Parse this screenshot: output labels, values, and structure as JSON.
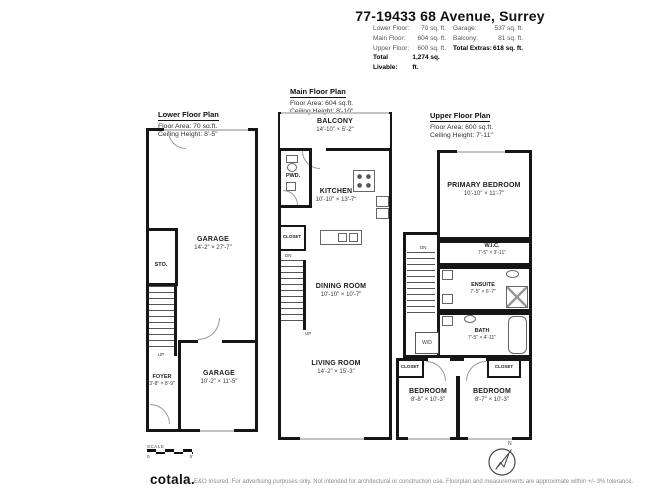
{
  "header": {
    "title": "77-19433 68 Avenue, Surrey",
    "left_rows": [
      {
        "label": "Lower Floor:",
        "value": "70 sq. ft."
      },
      {
        "label": "Main Floor:",
        "value": "604 sq. ft."
      },
      {
        "label": "Upper Floor:",
        "value": "600 sq. ft."
      }
    ],
    "left_total": {
      "label": "Total Livable:",
      "value": "1,274 sq. ft."
    },
    "right_rows": [
      {
        "label": "Garage:",
        "value": "537 sq. ft."
      },
      {
        "label": "Balcony:",
        "value": "81 sq. ft."
      }
    ],
    "right_total": {
      "label": "Total Extras:",
      "value": "618 sq. ft."
    }
  },
  "plans": {
    "lower": {
      "title": "Lower Floor Plan",
      "area": "Floor Area: 70 sq.ft.",
      "ceiling": "Ceiling Height: 8'-5\"",
      "garage_main": {
        "name": "GARAGE",
        "dims": "14'-2\" × 27'-7\""
      },
      "storage": {
        "name": "STO."
      },
      "stairs_up": "UP",
      "foyer": {
        "name": "FOYER",
        "dims": "3'-8\" × 8'-9\""
      },
      "garage_small": {
        "name": "GARAGE",
        "dims": "10'-2\" × 11'-5\""
      }
    },
    "main": {
      "title": "Main Floor Plan",
      "area": "Floor Area: 604 sq.ft.",
      "ceiling": "Ceiling Height: 8'-10\"",
      "balcony": {
        "name": "BALCONY",
        "dims": "14'-10\" × 5'-2\""
      },
      "powder": {
        "name": "PWD."
      },
      "kitchen": {
        "name": "KITCHEN",
        "dims": "10'-10\" × 13'-7\""
      },
      "closet": {
        "name": "CLOSET"
      },
      "stairs_dn": "DN",
      "stairs_up": "UP",
      "dining": {
        "name": "DINING ROOM",
        "dims": "10'-10\" × 10'-7\""
      },
      "living": {
        "name": "LIVING ROOM",
        "dims": "14'-2\" × 15'-3\""
      }
    },
    "upper": {
      "title": "Upper Floor Plan",
      "area": "Floor Area: 600 sq.ft.",
      "ceiling": "Ceiling Height: 7'-11\"",
      "primary": {
        "name": "PRIMARY BEDROOM",
        "dims": "10'-10\" × 11'-7\""
      },
      "wic": {
        "name": "W.I.C.",
        "dims": "7'-5\" × 3'-11\""
      },
      "ensuite": {
        "name": "ENSUITE",
        "dims": "7'-5\" × 6'-7\""
      },
      "bath": {
        "name": "BATH",
        "dims": "7'-5\" × 4'-11\""
      },
      "washer_dryer": "W/D",
      "stairs_dn": "DN",
      "closet_left": "CLOSET",
      "closet_right": "CLOSET",
      "bedroom_left": {
        "name": "BEDROOM",
        "dims": "8'-8\" × 10'-3\""
      },
      "bedroom_right": {
        "name": "BEDROOM",
        "dims": "8'-7\" × 10'-3\""
      }
    }
  },
  "scale": {
    "label": "SCALE",
    "start": "0",
    "end": "5'"
  },
  "compass": {
    "north": "N"
  },
  "footer": {
    "logo": "cotala.",
    "disclaimer": "E&O Insured. For advertising purposes only. Not intended for architectural or construction use. Floorplan and measurements are approximate within +/- 3% tolerance."
  }
}
